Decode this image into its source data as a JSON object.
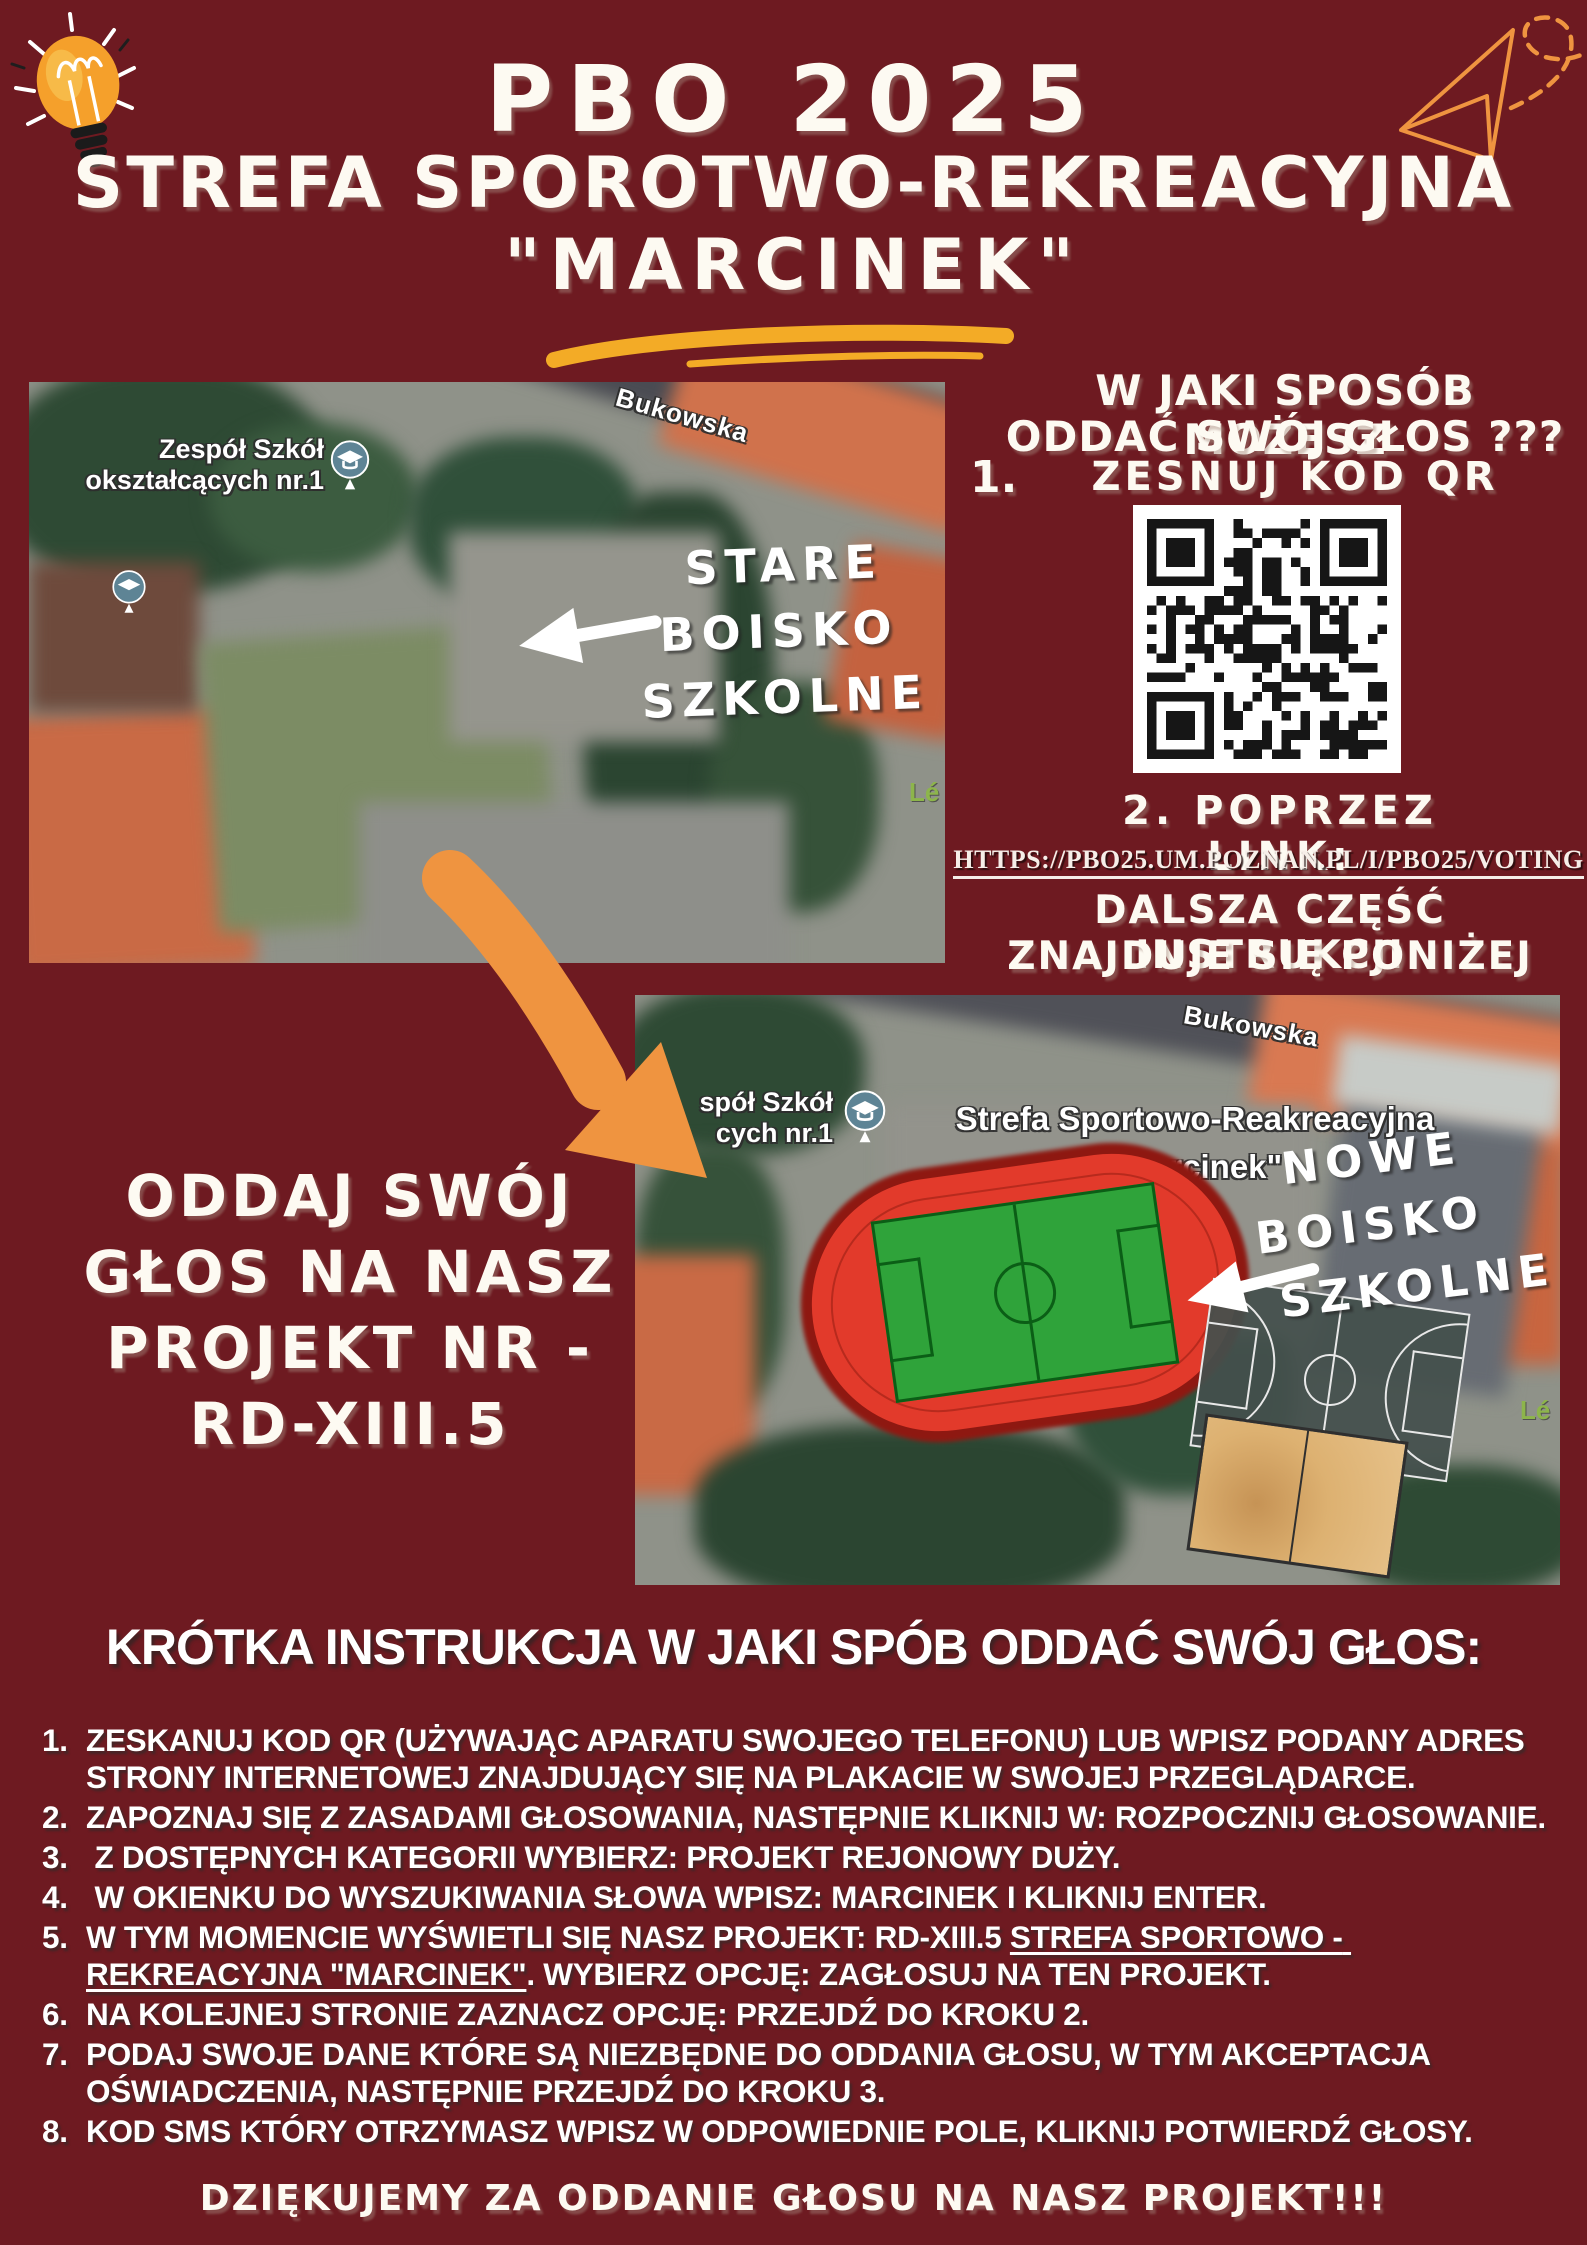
{
  "poster": {
    "title_line1": "PBO 2025",
    "title_line2": "STREFA SPOROTWO-REKREACYJNA",
    "title_line3": "\"MARCINEK\""
  },
  "colors": {
    "background": "#6E1A21",
    "accent_orange": "#EF9440",
    "accent_yellow": "#F3AB26",
    "track_red": "#E23A2B",
    "pitch_green": "#2FA33A",
    "qr_black": "#161616"
  },
  "map_old": {
    "street_label": "Bukowska",
    "place_label_line1": "Zespół Szkół",
    "place_label_line2": "okształcących nr.1",
    "partial_label": "Lé",
    "annotation_line1": "STARE",
    "annotation_line2": "BOISKO",
    "annotation_line3": "SZKOLNE"
  },
  "vote_howto": {
    "heading_line1": "W JAKI SPOSÓB MOŻESZ",
    "heading_line2": "ODDAĆ SWÓJ GŁOS ???",
    "step1_number": "1.",
    "step1_label": "ZESNUJ KOD QR",
    "step2_label": "2. POPRZEZ LINK:",
    "link": "HTTPS://PBO25.UM.POZNAN.PL/I/PBO25/VOTING",
    "note_line1": "DALSZA CZĘŚĆ INSTRUKCJI",
    "note_line2": "ZNAJDUJE SIĘ PONIŻEJ"
  },
  "cta": {
    "line1": "ODDAJ SWÓJ",
    "line2": "GŁOS NA NASZ",
    "line3": "PROJEKT NR -",
    "line4": "RD-XIII.5"
  },
  "map_new": {
    "street_label": "Bukowska",
    "place_label_line1": "spół Szkół",
    "place_label_line2": "cych nr.1",
    "title_line1": "Strefa Sportowo-Reakreacyjna",
    "title_line2": "\"Marcinek\"",
    "partial_label": "Lé",
    "annotation_line1": "NOWE",
    "annotation_line2": "BOISKO",
    "annotation_line3": "SZKOLNE"
  },
  "instructions": {
    "heading": "KRÓTKA INSTRUKCJA W JAKI SPÓB ODDAĆ SWÓJ GŁOS:",
    "items": [
      {
        "num": "1.",
        "text": "ZESKANUJ KOD QR (UŻYWAJĄC APARATU SWOJEGO TELEFONU) LUB WPISZ PODANY ADRES STRONY INTERNETOWEJ ZNAJDUJĄCY SIĘ NA PLAKACIE W SWOJEJ PRZEGLĄDARCE."
      },
      {
        "num": "2.",
        "text": "ZAPOZNAJ SIĘ Z ZASADAMI GŁOSOWANIA, NASTĘPNIE KLIKNIJ W: ROZPOCZNIJ GŁOSOWANIE."
      },
      {
        "num": "3.",
        "text": " Z DOSTĘPNYCH KATEGORII WYBIERZ: PROJEKT REJONOWY DUŻY."
      },
      {
        "num": "4.",
        "text": " W OKIENKU DO WYSZUKIWANIA SŁOWA WPISZ: MARCINEK I KLIKNIJ ENTER."
      },
      {
        "num": "5.",
        "pre": "W TYM MOMENCIE WYŚWIETLI SIĘ NASZ PROJEKT: ",
        "bold": "RD-XIII.5 ",
        "bold_underline": "STREFA SPORTOWO - REKREACYJNA \"MARCINEK\"",
        "post": ". WYBIERZ OPCJĘ: ZAGŁOSUJ NA TEN PROJEKT."
      },
      {
        "num": "6.",
        "text": "NA KOLEJNEJ STRONIE ZAZNACZ OPCJĘ: PRZEJDŹ DO KROKU 2."
      },
      {
        "num": "7.",
        "text": "PODAJ SWOJE DANE KTÓRE SĄ NIEZBĘDNE DO ODDANIA GŁOSU, W TYM AKCEPTACJA OŚWIADCZENIA, NASTĘPNIE PRZEJDŹ DO KROKU 3."
      },
      {
        "num": "8.",
        "text": "KOD SMS KTÓRY OTRZYMASZ WPISZ W ODPOWIEDNIE POLE, KLIKNIJ POTWIERDŹ GŁOSY."
      }
    ]
  },
  "footer": {
    "thanks": "DZIĘKUJEMY ZA ODDANIE GŁOSU NA NASZ PROJEKT!!!"
  }
}
